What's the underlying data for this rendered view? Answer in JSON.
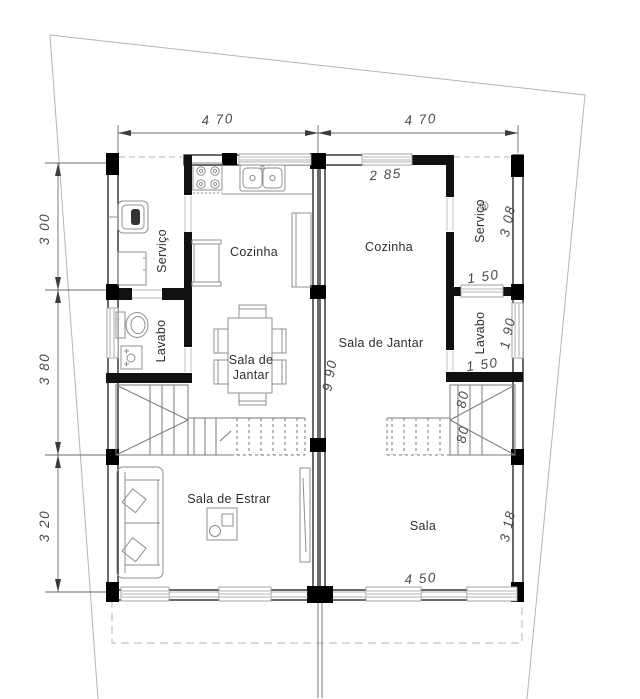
{
  "plan": {
    "type": "architectural-floor-plan",
    "units": {
      "left_unit_rooms": [
        "Serviço",
        "Cozinha",
        "Lavabo",
        "Sala de Jantar",
        "Sala de Estrar"
      ],
      "right_unit_rooms": [
        "Cozinha",
        "Serviço",
        "Sala de Jantar",
        "Lavabo",
        "Sala"
      ]
    },
    "dimensions_shown": [
      "4 70",
      "4 70",
      "3 00",
      "3 80",
      "3 20",
      "2 85",
      "3 08",
      "1 50",
      "1 90",
      "1 50",
      "80",
      "80",
      "9 90",
      "3 18",
      "4 50"
    ],
    "labels": [
      {
        "id": "dim-width-left",
        "text": "4 70",
        "x": 218,
        "y": 124,
        "rot": -4,
        "cls": "dim"
      },
      {
        "id": "dim-width-right",
        "text": "4 70",
        "x": 421,
        "y": 124,
        "rot": -4,
        "cls": "dim"
      },
      {
        "id": "dim-left-upper",
        "text": "3 00",
        "x": 49,
        "y": 229,
        "rot": -90,
        "cls": "dim"
      },
      {
        "id": "dim-left-middle",
        "text": "3 80",
        "x": 49,
        "y": 369,
        "rot": -90,
        "cls": "dim"
      },
      {
        "id": "dim-left-lower",
        "text": "3 20",
        "x": 49,
        "y": 526,
        "rot": -90,
        "cls": "dim"
      },
      {
        "id": "dim-kitchen-window",
        "text": "2 85",
        "x": 386,
        "y": 179,
        "rot": -5,
        "cls": "dim"
      },
      {
        "id": "dim-servico-right",
        "text": "3 08",
        "x": 512,
        "y": 222,
        "rot": -78,
        "cls": "dim"
      },
      {
        "id": "dim-servico-window",
        "text": "1 50",
        "x": 484,
        "y": 281,
        "rot": -8,
        "cls": "dim"
      },
      {
        "id": "dim-lavabo-right",
        "text": "1 90",
        "x": 512,
        "y": 334,
        "rot": -78,
        "cls": "dim"
      },
      {
        "id": "dim-lavabo-width",
        "text": "1 50",
        "x": 483,
        "y": 369,
        "rot": -8,
        "cls": "dim"
      },
      {
        "id": "dim-stair-80-upper",
        "text": "80",
        "x": 467,
        "y": 400,
        "rot": -78,
        "cls": "dim"
      },
      {
        "id": "dim-stair-80-lower",
        "text": "80",
        "x": 467,
        "y": 435,
        "rot": -78,
        "cls": "dim"
      },
      {
        "id": "dim-depth-990",
        "text": "9 90",
        "x": 334,
        "y": 376,
        "rot": -80,
        "cls": "dim"
      },
      {
        "id": "dim-sala-right",
        "text": "3 18",
        "x": 512,
        "y": 527,
        "rot": -78,
        "cls": "dim"
      },
      {
        "id": "dim-sala-window",
        "text": "4 50",
        "x": 421,
        "y": 583,
        "rot": -4,
        "cls": "dim"
      },
      {
        "id": "room-servico-left",
        "text": "Serviço",
        "x": 166,
        "y": 251,
        "rot": -90,
        "cls": "room"
      },
      {
        "id": "room-cozinha-left",
        "text": "Cozinha",
        "x": 254,
        "y": 256,
        "rot": 0,
        "cls": "room"
      },
      {
        "id": "room-lavabo-left",
        "text": "Lavabo",
        "x": 165,
        "y": 341,
        "rot": -90,
        "cls": "room"
      },
      {
        "id": "room-jantar-left-1",
        "text": "Sala de",
        "x": 251,
        "y": 364,
        "rot": 0,
        "cls": "room"
      },
      {
        "id": "room-jantar-left-2",
        "text": "Jantar",
        "x": 251,
        "y": 379,
        "rot": 0,
        "cls": "room"
      },
      {
        "id": "room-estar-left",
        "text": "Sala de Estrar",
        "x": 229,
        "y": 503,
        "rot": 0,
        "cls": "room"
      },
      {
        "id": "room-cozinha-right",
        "text": "Cozinha",
        "x": 389,
        "y": 251,
        "rot": 0,
        "cls": "room"
      },
      {
        "id": "room-servico-right",
        "text": "Serviço",
        "x": 484,
        "y": 221,
        "rot": -90,
        "cls": "room"
      },
      {
        "id": "room-jantar-right",
        "text": "Sala de Jantar",
        "x": 381,
        "y": 347,
        "rot": 0,
        "cls": "room"
      },
      {
        "id": "room-lavabo-right",
        "text": "Lavabo",
        "x": 484,
        "y": 333,
        "rot": -90,
        "cls": "room"
      },
      {
        "id": "room-sala-right",
        "text": "Sala",
        "x": 423,
        "y": 530,
        "rot": 0,
        "cls": "room"
      }
    ],
    "colors": {
      "background": "#ffffff",
      "walls": "#1a1a1a",
      "partitions": "#111111",
      "furniture_lines": "#8f8f8f",
      "boundary_lines": "#b5b5b5",
      "dimension_text": "#4a4a4a",
      "room_text": "#2e2e2e"
    }
  }
}
